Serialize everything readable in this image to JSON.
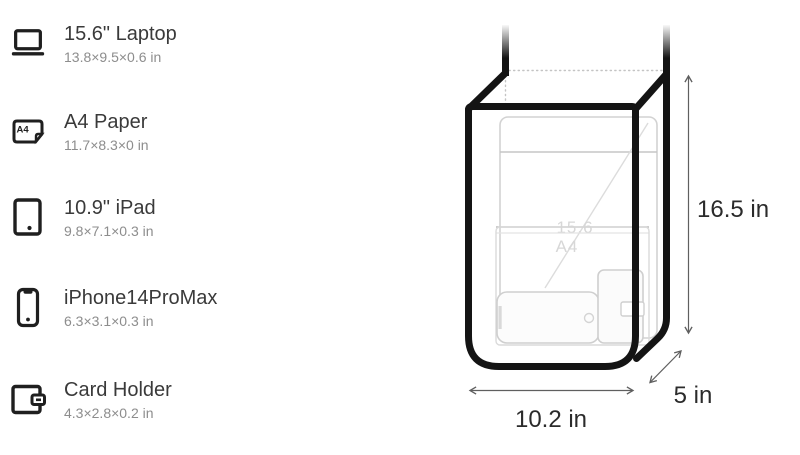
{
  "legend": {
    "items": [
      {
        "icon": "laptop-icon",
        "name": "15.6\" Laptop",
        "dims": "13.8×9.5×0.6 in"
      },
      {
        "icon": "a4-paper-icon",
        "name": "A4 Paper",
        "dims": "11.7×8.3×0 in",
        "icon_label": "A4"
      },
      {
        "icon": "ipad-icon",
        "name": "10.9\" iPad",
        "dims": "9.8×7.1×0.3 in"
      },
      {
        "icon": "iphone-icon",
        "name": "iPhone14ProMax",
        "dims": "6.3×3.1×0.3 in"
      },
      {
        "icon": "card-holder-icon",
        "name": "Card Holder",
        "dims": "4.3×2.8×0.2 in"
      }
    ]
  },
  "diagram": {
    "height_label": "16.5 in",
    "width_label": "10.2 in",
    "depth_label": "5 in",
    "watermarks": {
      "laptop": "15.6",
      "paper": "A4"
    },
    "colors": {
      "bag_outline": "#141414",
      "icon_stroke": "#1f1f1f",
      "ghost_stroke": "#d0d0d0",
      "dimension_line": "#5f5f5f",
      "dimension_text": "#2b2b2b",
      "legend_title": "#3a3a3a",
      "legend_subtitle": "#8d8d8d"
    }
  }
}
